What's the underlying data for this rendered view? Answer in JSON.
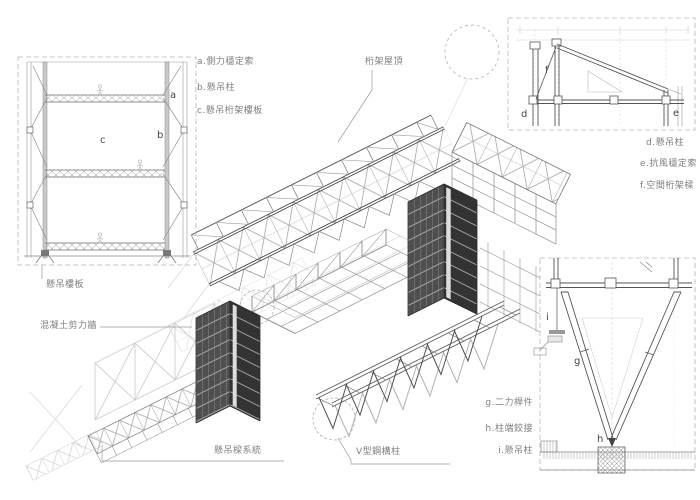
{
  "colors": {
    "background": "#ffffff",
    "line_dark": "#4a4a4a",
    "line_mid": "#777777",
    "line_light": "#aaaaaa",
    "tower_face_light": "#4f4f4f",
    "tower_face_dark": "#333333",
    "label_text": "#7e7e7e"
  },
  "labels": {
    "roof_truss": "桁架屋頂",
    "suspended_floor_slab": "懸吊樓板",
    "concrete_shear_wall": "混凝土剪力牆",
    "suspended_beam_system": "懸吊樑系統",
    "v_steel_column": "V型鋼構柱"
  },
  "legend_left": {
    "items": [
      {
        "label": "a.側力穩定索"
      },
      {
        "label": "b.懸吊柱"
      },
      {
        "label": "c.懸吊桁架樓板"
      }
    ]
  },
  "legend_right": {
    "items": [
      {
        "label": "d.懸吊柱"
      },
      {
        "label": "e.抗風穩定索"
      },
      {
        "label": "f.空間桁架樑"
      }
    ]
  },
  "legend_bottom": {
    "items": [
      {
        "label": "g.二力桿件"
      },
      {
        "label": "h.柱端鉸接"
      },
      {
        "label": "i.懸吊柱"
      }
    ]
  },
  "detail_letters": {
    "a": "a",
    "b": "b",
    "c": "c",
    "d": "d",
    "e": "e",
    "f": "f",
    "g": "g",
    "h": "h",
    "i": "i"
  }
}
